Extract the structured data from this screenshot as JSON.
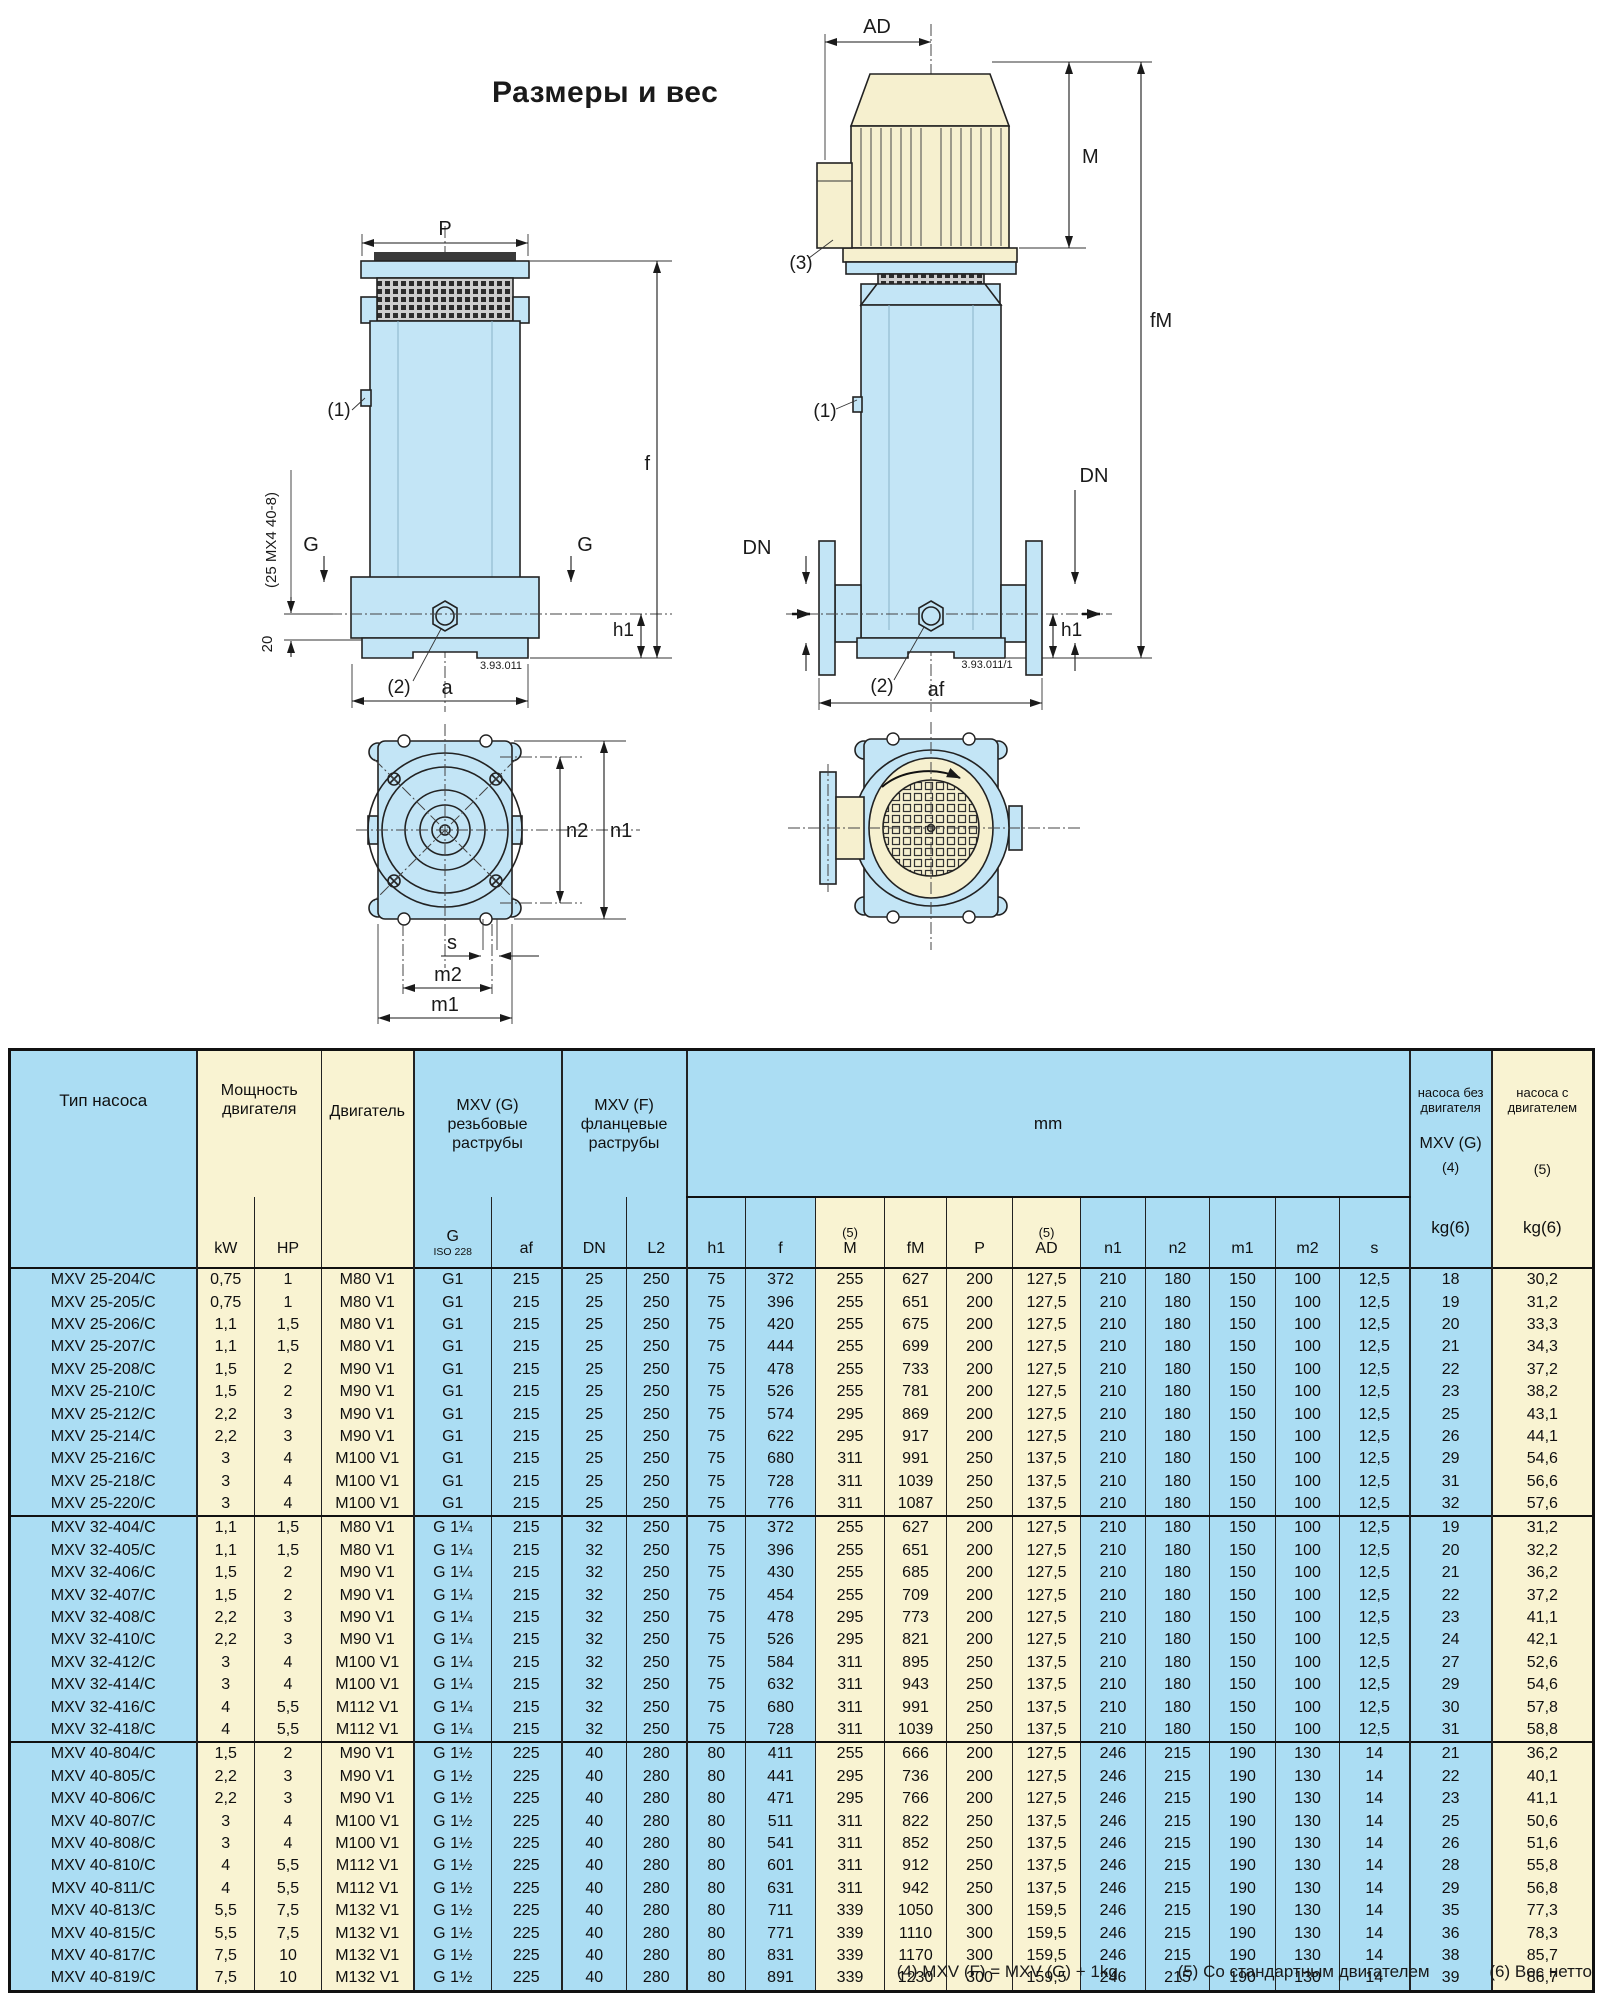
{
  "title": "Размеры и вес",
  "colors": {
    "table_blue": "#abddf3",
    "table_cream": "#f9f3d2",
    "drawing_blue": "#c3e5f6",
    "drawing_cream": "#f6f0cf"
  },
  "drawings": {
    "threaded_side": {
      "p": "P",
      "f": "f",
      "g_left": "G",
      "g_right": "G",
      "h1": "h1",
      "a": "a",
      "c1": "(1)",
      "c2": "(2)",
      "d20": "20",
      "note": "(25 MX4 40-8)",
      "num": "3.93.011"
    },
    "flanged_side": {
      "ad": "AD",
      "m": "M",
      "fm": "fM",
      "c1": "(1)",
      "c2": "(2)",
      "c3": "(3)",
      "dn_left": "DN",
      "dn_right": "DN",
      "h1": "h1",
      "af": "af",
      "num": "3.93.011/1"
    },
    "top_view": {
      "n1": "n1",
      "n2": "n2",
      "s": "s",
      "m2": "m2",
      "m1": "m1"
    }
  },
  "table": {
    "header": {
      "pump_type": "Тип насоса",
      "power": {
        "l1": "Мощность",
        "l2": "двигателя"
      },
      "motor": "Двигатель",
      "mxv_g": {
        "l1": "MXV (G)",
        "l2": "резьбовые",
        "l3": "раструбы"
      },
      "mxv_f": {
        "l1": "MXV (F)",
        "l2": "фланцевые",
        "l3": "раструбы"
      },
      "mm": "mm",
      "weight_without": {
        "l1": "насоса без",
        "l2": "двигателя",
        "l3": "MXV (G)",
        "l4": "(4)",
        "l5": "kg(6)"
      },
      "weight_with": {
        "l1": "насоса с",
        "l2": "двигателем",
        "l3": "(5)",
        "l4": "kg(6)"
      },
      "sub": {
        "kw": "kW",
        "hp": "HP",
        "g": "G",
        "iso": "ISO 228",
        "af": "af",
        "dn": "DN",
        "l2": "L2",
        "h1": "h1",
        "f": "f",
        "note5_m": "(5)",
        "m": "M",
        "fm": "fM",
        "p": "P",
        "note5_ad": "(5)",
        "ad": "AD",
        "n1": "n1",
        "n2": "n2",
        "m1": "m1",
        "m2": "m2",
        "s": "s"
      }
    },
    "groups": [
      {
        "rows": [
          [
            "MXV 25-204/C",
            "0,75",
            "1",
            "M80 V1",
            "G1",
            "215",
            "25",
            "250",
            "75",
            "372",
            "255",
            "627",
            "200",
            "127,5",
            "210",
            "180",
            "150",
            "100",
            "12,5",
            "18",
            "30,2"
          ],
          [
            "MXV 25-205/C",
            "0,75",
            "1",
            "M80 V1",
            "G1",
            "215",
            "25",
            "250",
            "75",
            "396",
            "255",
            "651",
            "200",
            "127,5",
            "210",
            "180",
            "150",
            "100",
            "12,5",
            "19",
            "31,2"
          ],
          [
            "MXV 25-206/C",
            "1,1",
            "1,5",
            "M80 V1",
            "G1",
            "215",
            "25",
            "250",
            "75",
            "420",
            "255",
            "675",
            "200",
            "127,5",
            "210",
            "180",
            "150",
            "100",
            "12,5",
            "20",
            "33,3"
          ],
          [
            "MXV 25-207/C",
            "1,1",
            "1,5",
            "M80 V1",
            "G1",
            "215",
            "25",
            "250",
            "75",
            "444",
            "255",
            "699",
            "200",
            "127,5",
            "210",
            "180",
            "150",
            "100",
            "12,5",
            "21",
            "34,3"
          ],
          [
            "MXV 25-208/C",
            "1,5",
            "2",
            "M90 V1",
            "G1",
            "215",
            "25",
            "250",
            "75",
            "478",
            "255",
            "733",
            "200",
            "127,5",
            "210",
            "180",
            "150",
            "100",
            "12,5",
            "22",
            "37,2"
          ],
          [
            "MXV 25-210/C",
            "1,5",
            "2",
            "M90 V1",
            "G1",
            "215",
            "25",
            "250",
            "75",
            "526",
            "255",
            "781",
            "200",
            "127,5",
            "210",
            "180",
            "150",
            "100",
            "12,5",
            "23",
            "38,2"
          ],
          [
            "MXV 25-212/C",
            "2,2",
            "3",
            "M90 V1",
            "G1",
            "215",
            "25",
            "250",
            "75",
            "574",
            "295",
            "869",
            "200",
            "127,5",
            "210",
            "180",
            "150",
            "100",
            "12,5",
            "25",
            "43,1"
          ],
          [
            "MXV 25-214/C",
            "2,2",
            "3",
            "M90 V1",
            "G1",
            "215",
            "25",
            "250",
            "75",
            "622",
            "295",
            "917",
            "200",
            "127,5",
            "210",
            "180",
            "150",
            "100",
            "12,5",
            "26",
            "44,1"
          ],
          [
            "MXV 25-216/C",
            "3",
            "4",
            "M100 V1",
            "G1",
            "215",
            "25",
            "250",
            "75",
            "680",
            "311",
            "991",
            "250",
            "137,5",
            "210",
            "180",
            "150",
            "100",
            "12,5",
            "29",
            "54,6"
          ],
          [
            "MXV 25-218/C",
            "3",
            "4",
            "M100 V1",
            "G1",
            "215",
            "25",
            "250",
            "75",
            "728",
            "311",
            "1039",
            "250",
            "137,5",
            "210",
            "180",
            "150",
            "100",
            "12,5",
            "31",
            "56,6"
          ],
          [
            "MXV 25-220/C",
            "3",
            "4",
            "M100 V1",
            "G1",
            "215",
            "25",
            "250",
            "75",
            "776",
            "311",
            "1087",
            "250",
            "137,5",
            "210",
            "180",
            "150",
            "100",
            "12,5",
            "32",
            "57,6"
          ]
        ]
      },
      {
        "rows": [
          [
            "MXV 32-404/C",
            "1,1",
            "1,5",
            "M80 V1",
            "G 1¼",
            "215",
            "32",
            "250",
            "75",
            "372",
            "255",
            "627",
            "200",
            "127,5",
            "210",
            "180",
            "150",
            "100",
            "12,5",
            "19",
            "31,2"
          ],
          [
            "MXV 32-405/C",
            "1,1",
            "1,5",
            "M80 V1",
            "G 1¼",
            "215",
            "32",
            "250",
            "75",
            "396",
            "255",
            "651",
            "200",
            "127,5",
            "210",
            "180",
            "150",
            "100",
            "12,5",
            "20",
            "32,2"
          ],
          [
            "MXV 32-406/C",
            "1,5",
            "2",
            "M90 V1",
            "G 1¼",
            "215",
            "32",
            "250",
            "75",
            "430",
            "255",
            "685",
            "200",
            "127,5",
            "210",
            "180",
            "150",
            "100",
            "12,5",
            "21",
            "36,2"
          ],
          [
            "MXV 32-407/C",
            "1,5",
            "2",
            "M90 V1",
            "G 1¼",
            "215",
            "32",
            "250",
            "75",
            "454",
            "255",
            "709",
            "200",
            "127,5",
            "210",
            "180",
            "150",
            "100",
            "12,5",
            "22",
            "37,2"
          ],
          [
            "MXV 32-408/C",
            "2,2",
            "3",
            "M90 V1",
            "G 1¼",
            "215",
            "32",
            "250",
            "75",
            "478",
            "295",
            "773",
            "200",
            "127,5",
            "210",
            "180",
            "150",
            "100",
            "12,5",
            "23",
            "41,1"
          ],
          [
            "MXV 32-410/C",
            "2,2",
            "3",
            "M90 V1",
            "G 1¼",
            "215",
            "32",
            "250",
            "75",
            "526",
            "295",
            "821",
            "200",
            "127,5",
            "210",
            "180",
            "150",
            "100",
            "12,5",
            "24",
            "42,1"
          ],
          [
            "MXV 32-412/C",
            "3",
            "4",
            "M100 V1",
            "G 1¼",
            "215",
            "32",
            "250",
            "75",
            "584",
            "311",
            "895",
            "250",
            "137,5",
            "210",
            "180",
            "150",
            "100",
            "12,5",
            "27",
            "52,6"
          ],
          [
            "MXV 32-414/C",
            "3",
            "4",
            "M100 V1",
            "G 1¼",
            "215",
            "32",
            "250",
            "75",
            "632",
            "311",
            "943",
            "250",
            "137,5",
            "210",
            "180",
            "150",
            "100",
            "12,5",
            "29",
            "54,6"
          ],
          [
            "MXV 32-416/C",
            "4",
            "5,5",
            "M112 V1",
            "G 1¼",
            "215",
            "32",
            "250",
            "75",
            "680",
            "311",
            "991",
            "250",
            "137,5",
            "210",
            "180",
            "150",
            "100",
            "12,5",
            "30",
            "57,8"
          ],
          [
            "MXV 32-418/C",
            "4",
            "5,5",
            "M112 V1",
            "G 1¼",
            "215",
            "32",
            "250",
            "75",
            "728",
            "311",
            "1039",
            "250",
            "137,5",
            "210",
            "180",
            "150",
            "100",
            "12,5",
            "31",
            "58,8"
          ]
        ]
      },
      {
        "rows": [
          [
            "MXV 40-804/C",
            "1,5",
            "2",
            "M90 V1",
            "G 1½",
            "225",
            "40",
            "280",
            "80",
            "411",
            "255",
            "666",
            "200",
            "127,5",
            "246",
            "215",
            "190",
            "130",
            "14",
            "21",
            "36,2"
          ],
          [
            "MXV 40-805/C",
            "2,2",
            "3",
            "M90 V1",
            "G 1½",
            "225",
            "40",
            "280",
            "80",
            "441",
            "295",
            "736",
            "200",
            "127,5",
            "246",
            "215",
            "190",
            "130",
            "14",
            "22",
            "40,1"
          ],
          [
            "MXV 40-806/C",
            "2,2",
            "3",
            "M90 V1",
            "G 1½",
            "225",
            "40",
            "280",
            "80",
            "471",
            "295",
            "766",
            "200",
            "127,5",
            "246",
            "215",
            "190",
            "130",
            "14",
            "23",
            "41,1"
          ],
          [
            "MXV 40-807/C",
            "3",
            "4",
            "M100 V1",
            "G 1½",
            "225",
            "40",
            "280",
            "80",
            "511",
            "311",
            "822",
            "250",
            "137,5",
            "246",
            "215",
            "190",
            "130",
            "14",
            "25",
            "50,6"
          ],
          [
            "MXV 40-808/C",
            "3",
            "4",
            "M100 V1",
            "G 1½",
            "225",
            "40",
            "280",
            "80",
            "541",
            "311",
            "852",
            "250",
            "137,5",
            "246",
            "215",
            "190",
            "130",
            "14",
            "26",
            "51,6"
          ],
          [
            "MXV 40-810/C",
            "4",
            "5,5",
            "M112 V1",
            "G 1½",
            "225",
            "40",
            "280",
            "80",
            "601",
            "311",
            "912",
            "250",
            "137,5",
            "246",
            "215",
            "190",
            "130",
            "14",
            "28",
            "55,8"
          ],
          [
            "MXV 40-811/C",
            "4",
            "5,5",
            "M112 V1",
            "G 1½",
            "225",
            "40",
            "280",
            "80",
            "631",
            "311",
            "942",
            "250",
            "137,5",
            "246",
            "215",
            "190",
            "130",
            "14",
            "29",
            "56,8"
          ],
          [
            "MXV 40-813/C",
            "5,5",
            "7,5",
            "M132 V1",
            "G 1½",
            "225",
            "40",
            "280",
            "80",
            "711",
            "339",
            "1050",
            "300",
            "159,5",
            "246",
            "215",
            "190",
            "130",
            "14",
            "35",
            "77,3"
          ],
          [
            "MXV 40-815/C",
            "5,5",
            "7,5",
            "M132 V1",
            "G 1½",
            "225",
            "40",
            "280",
            "80",
            "771",
            "339",
            "1110",
            "300",
            "159,5",
            "246",
            "215",
            "190",
            "130",
            "14",
            "36",
            "78,3"
          ],
          [
            "MXV 40-817/C",
            "7,5",
            "10",
            "M132 V1",
            "G 1½",
            "225",
            "40",
            "280",
            "80",
            "831",
            "339",
            "1170",
            "300",
            "159,5",
            "246",
            "215",
            "190",
            "130",
            "14",
            "38",
            "85,7"
          ],
          [
            "MXV 40-819/C",
            "7,5",
            "10",
            "M132 V1",
            "G 1½",
            "225",
            "40",
            "280",
            "80",
            "891",
            "339",
            "1230",
            "300",
            "159,5",
            "246",
            "215",
            "190",
            "130",
            "14",
            "39",
            "86,7"
          ]
        ]
      }
    ]
  },
  "footnotes": [
    "(4) MXV (F) = MXV (G) + 1kg",
    "(5) Со стандартным двигателем",
    "(6) Вес нетто"
  ]
}
